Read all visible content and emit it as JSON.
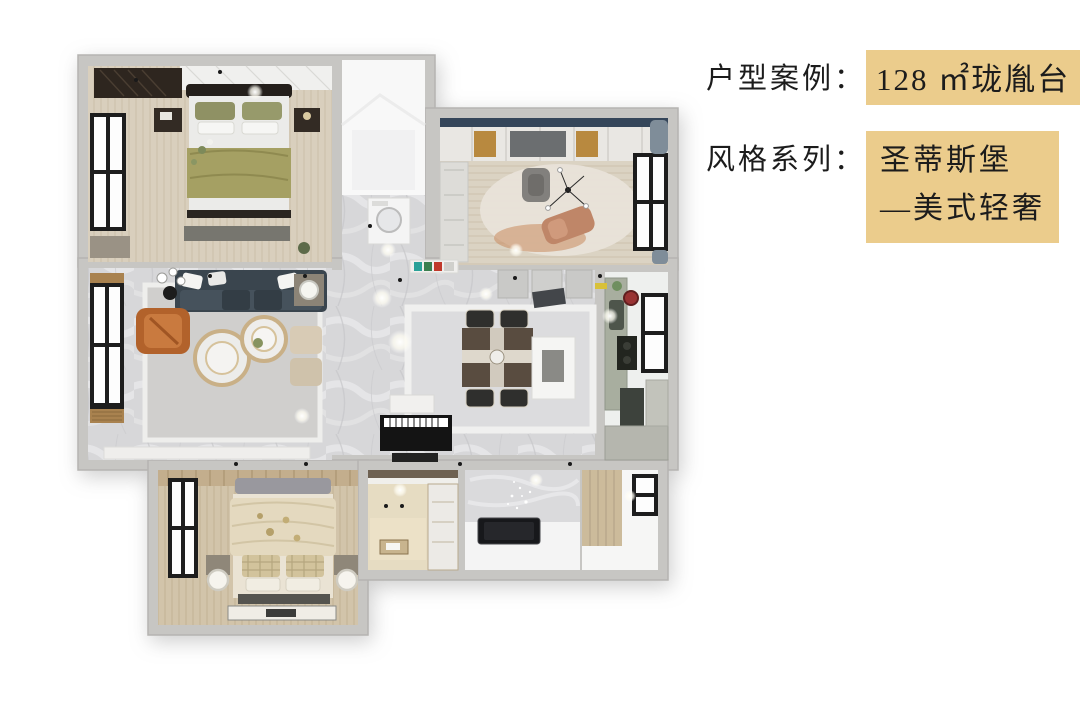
{
  "annotation": {
    "case_row": {
      "label": "户型案例：",
      "value": "128 ㎡珑胤台"
    },
    "style_row": {
      "label": "风格系列：",
      "value_line1": "圣蒂斯堡",
      "value_line2": "—美式轻奢"
    },
    "colors": {
      "highlight": "#ebcc8c",
      "text": "#1c1c1c"
    }
  },
  "floor_plan": {
    "rooms": [
      "master-bedroom",
      "white-bathroom",
      "entry-hall",
      "study-bedroom",
      "living-room",
      "dining-hall",
      "kitchen",
      "second-bedroom",
      "tatami-room",
      "bathroom",
      "balcony"
    ],
    "colors": {
      "wall": "#c7c6c3",
      "wood_floor": "#d9cfbd",
      "marble_floor": "#d7d7d9",
      "sofa_navy": "#3a454e",
      "armchair_orange": "#b2622b",
      "bed_olive": "#a5a063",
      "gold_accent": "#c9b087",
      "window_frame": "#1d1d1d"
    }
  }
}
